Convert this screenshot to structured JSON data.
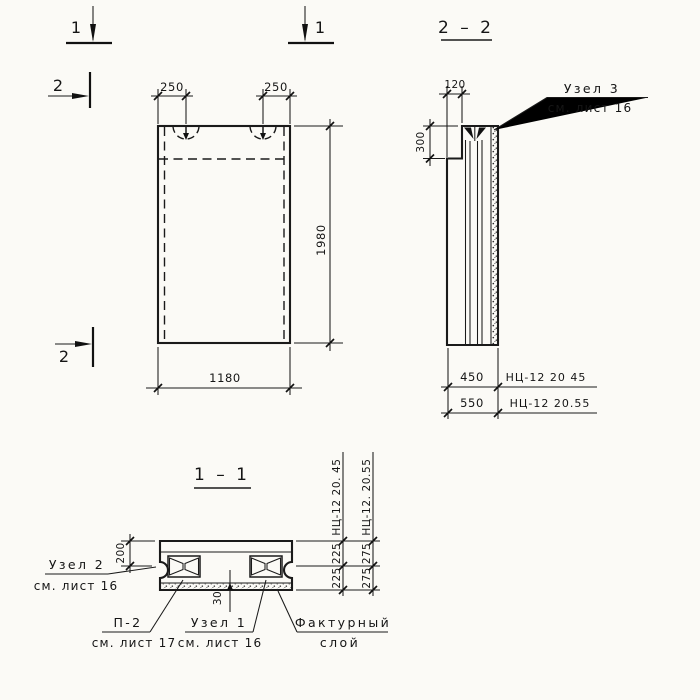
{
  "colors": {
    "ink": "#1a1a1a",
    "paper": "#fbfaf6"
  },
  "section_marks": {
    "one_left": "1",
    "one_right": "1",
    "two_top": "2",
    "two_bottom": "2"
  },
  "front_view": {
    "dim_hook_left": "250",
    "dim_hook_right": "250",
    "dim_width": "1180",
    "dim_height": "1980"
  },
  "s22": {
    "title": "2 – 2",
    "dim_top": "120",
    "dim_step": "300",
    "dim_width_a": "450",
    "dim_width_b": "550",
    "code_a": "НЦ-12 20 45",
    "code_b": "НЦ-12 20.55",
    "node3_line1": "Узел 3",
    "node3_line2": "см. лист 16"
  },
  "s11": {
    "title": "1 – 1",
    "dim_flange": "200",
    "dim_layer": "30",
    "dim_a_top": "225",
    "dim_a_bottom": "225",
    "dim_b_top": "275",
    "dim_b_bottom": "275",
    "code_a": "НЦ-12 20. 45",
    "code_b": "НЦ-12. 20.55",
    "node2_line1": "Узел 2",
    "node2_line2": "см. лист 16",
    "p2_line1": "П-2",
    "p2_line2": "см. лист 17",
    "node1_line1": "Узел 1",
    "node1_line2": "см. лист 16",
    "facing_line1": "Фактурный",
    "facing_line2": "слой"
  }
}
